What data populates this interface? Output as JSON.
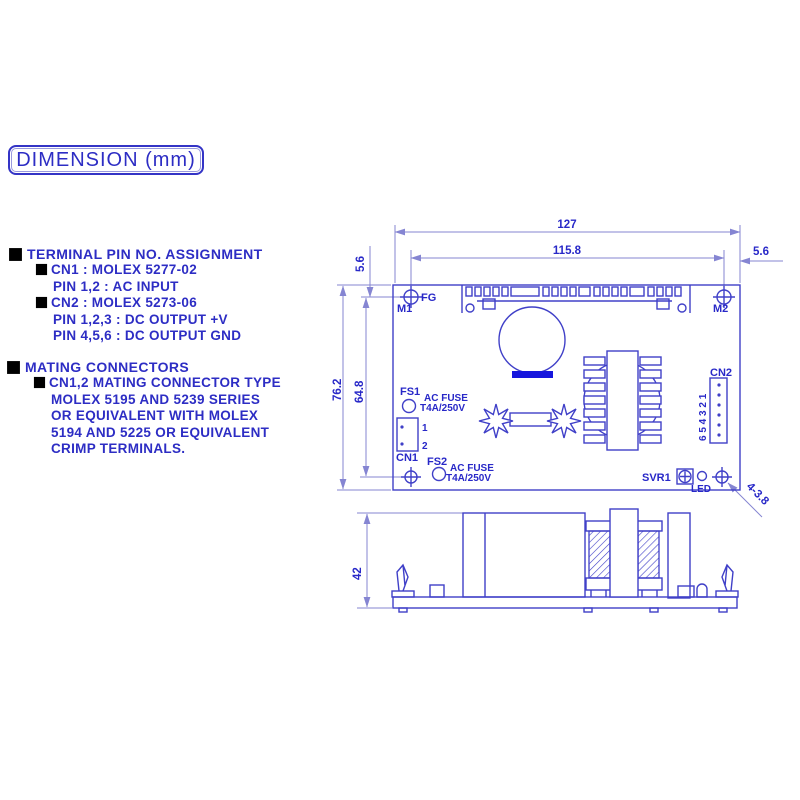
{
  "title": "DIMENSION (mm)",
  "notes": {
    "terminal_heading": "TERMINAL PIN NO. ASSIGNMENT",
    "terminal_cn1": "CN1 : MOLEX 5277-02",
    "terminal_cn1_pins": "PIN 1,2 : AC INPUT",
    "terminal_cn2": "CN2 : MOLEX 5273-06",
    "terminal_cn2_pins1": "PIN 1,2,3 : DC OUTPUT +V",
    "terminal_cn2_pins2": "PIN 4,5,6 : DC OUTPUT GND",
    "mating_heading": "MATING CONNECTORS",
    "mating_line1": "CN1,2 MATING CONNECTOR TYPE",
    "mating_line2": "MOLEX 5195 AND 5239 SERIES",
    "mating_line3": "OR EQUIVALENT WITH MOLEX",
    "mating_line4": "5194 AND 5225 OR EQUIVALENT",
    "mating_line5": "CRIMP TERMINALS."
  },
  "dims": {
    "total_width": "127",
    "hole_span_width": "115.8",
    "edge_offset_left": "5.6",
    "edge_offset_right": "5.6",
    "total_height": "76.2",
    "hole_span_height": "64.8",
    "side_height": "42",
    "mounting_hole_note": "4-3.8"
  },
  "board": {
    "fg": "FG",
    "m1": "M1",
    "m2": "M2",
    "fs1": "FS1",
    "fs2": "FS2",
    "fuse1": {
      "l1": "AC FUSE",
      "l2": "T4A/250V"
    },
    "fuse2": {
      "l1": "AC FUSE",
      "l2": "T4A/250V"
    },
    "cn1": "CN1",
    "cn1_pin1": "1",
    "cn1_pin2": "2",
    "cn2": "CN2",
    "cn2_pin_numbers": "6 5 4 3 2 1",
    "svr1": "SVR1",
    "led": "LED"
  },
  "colors": {
    "outline": "#4040c8",
    "dimension": "#8585d2",
    "text": "#2828c8",
    "solid_fill": "#1616dd",
    "background": "#ffffff"
  }
}
